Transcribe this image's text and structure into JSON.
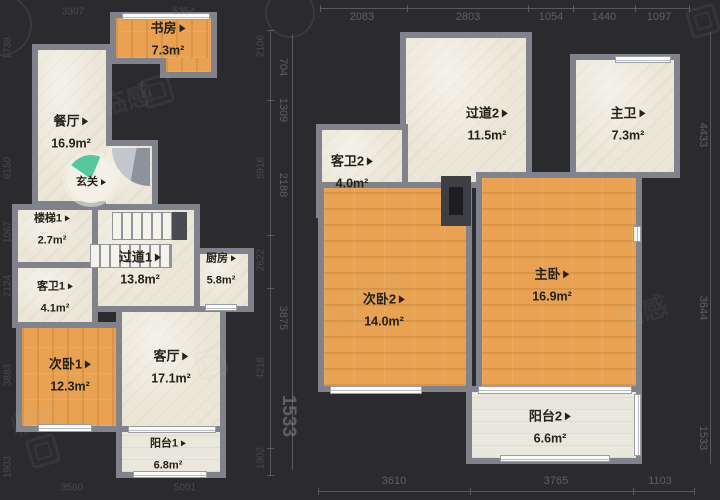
{
  "floor_plans": {
    "left": {
      "rooms": [
        {
          "name": "书房",
          "area": "7.3m²"
        },
        {
          "name": "餐厅",
          "area": "16.9m²"
        },
        {
          "name": "玄关",
          "area": ""
        },
        {
          "name": "楼梯1",
          "area": "2.7m²"
        },
        {
          "name": "过道1",
          "area": "13.8m²"
        },
        {
          "name": "厨房",
          "area": "5.8m²"
        },
        {
          "name": "客卫1",
          "area": "4.1m²"
        },
        {
          "name": "次卧1",
          "area": "12.3m²"
        },
        {
          "name": "客厅",
          "area": "17.1m²"
        },
        {
          "name": "阳台1",
          "area": "6.8m²"
        }
      ]
    },
    "right": {
      "rooms": [
        {
          "name": "过道2",
          "area": "11.5m²"
        },
        {
          "name": "主卫",
          "area": "7.3m²"
        },
        {
          "name": "客卫2",
          "area": "4.0m²"
        },
        {
          "name": "次卧2",
          "area": "14.0m²"
        },
        {
          "name": "主卧",
          "area": "16.9m²"
        },
        {
          "name": "阳台2",
          "area": "6.6m²"
        }
      ]
    }
  },
  "dimensions": {
    "top_left": [
      "3307",
      "5354"
    ],
    "top_right": [
      "2083",
      "2803",
      "1054",
      "1440",
      "1097"
    ],
    "left_edge": [
      "1738",
      "6150",
      "1067",
      "2124",
      "3883",
      "1903"
    ],
    "inner_left_col": [
      "2106",
      "5916",
      "2622",
      "4218",
      "1902"
    ],
    "inner_right_col": [
      "704",
      "1309",
      "2188",
      "3875"
    ],
    "inner_large": "1533",
    "right_edge": [
      "4433",
      "3644",
      "1533"
    ],
    "bottom_left": [
      "3560",
      "5001"
    ],
    "bottom_right": [
      "3610",
      "3765",
      "1103"
    ]
  },
  "watermark": {
    "text": "临感"
  },
  "colors": {
    "background": "#2b2b2d",
    "wall": "#80838b",
    "room_beige": "#ebe6d7",
    "room_wood": "#e8a251",
    "balcony": "#eae8dc",
    "entry_fan": "#55c8a0",
    "dim_text": "#828285",
    "label_text": "#242219"
  }
}
